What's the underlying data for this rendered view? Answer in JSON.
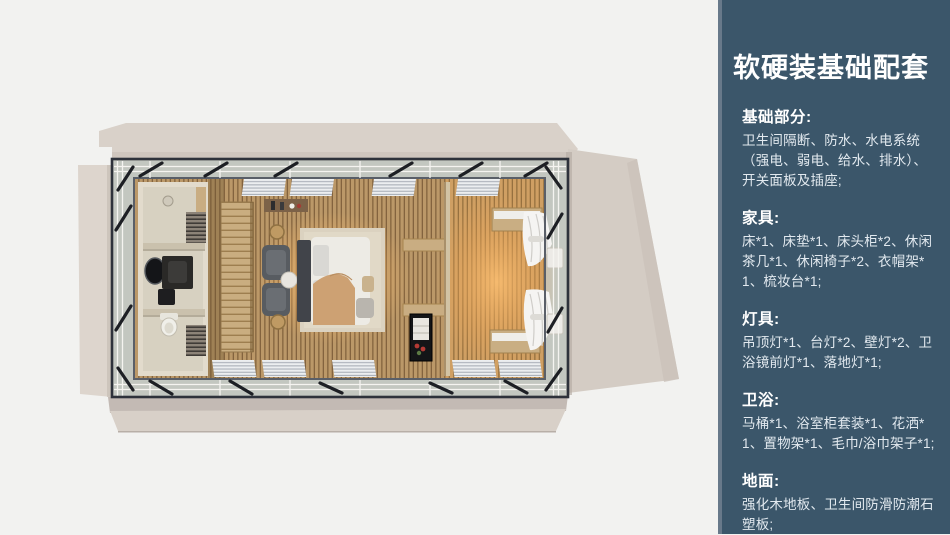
{
  "page": {
    "background": "#f2f2f0"
  },
  "floorplan": {
    "palette": {
      "deck": "#d8d0c8",
      "bedroom_floor": "#bb9868",
      "lounge_floor": "#cf9f63",
      "warm_glow": "#ffbe6e",
      "steel_frame": "#2e323b",
      "bathroom_wall": "#e2dbcc",
      "wardrobe_wood": "#c9ad80"
    }
  },
  "panel": {
    "bg": "#3b566a",
    "accent_strip": "#68798a",
    "title": "软硬装基础配套",
    "sections": [
      {
        "heading": "基础部分:",
        "body": "卫生间隔断、防水、水电系统（强电、弱电、给水、排水）、开关面板及插座;"
      },
      {
        "heading": "家具:",
        "body": "床*1、床垫*1、床头柜*2、休闲茶几*1、休闲椅子*2、衣帽架*1、梳妆台*1;"
      },
      {
        "heading": "灯具:",
        "body": "吊顶灯*1、台灯*2、壁灯*2、卫浴镜前灯*1、落地灯*1;"
      },
      {
        "heading": "卫浴:",
        "body": "马桶*1、浴室柜套装*1、花洒*1、置物架*1、毛巾/浴巾架子*1;"
      },
      {
        "heading": "地面:",
        "body": "强化木地板、卫生间防滑防潮石塑板;"
      }
    ]
  }
}
